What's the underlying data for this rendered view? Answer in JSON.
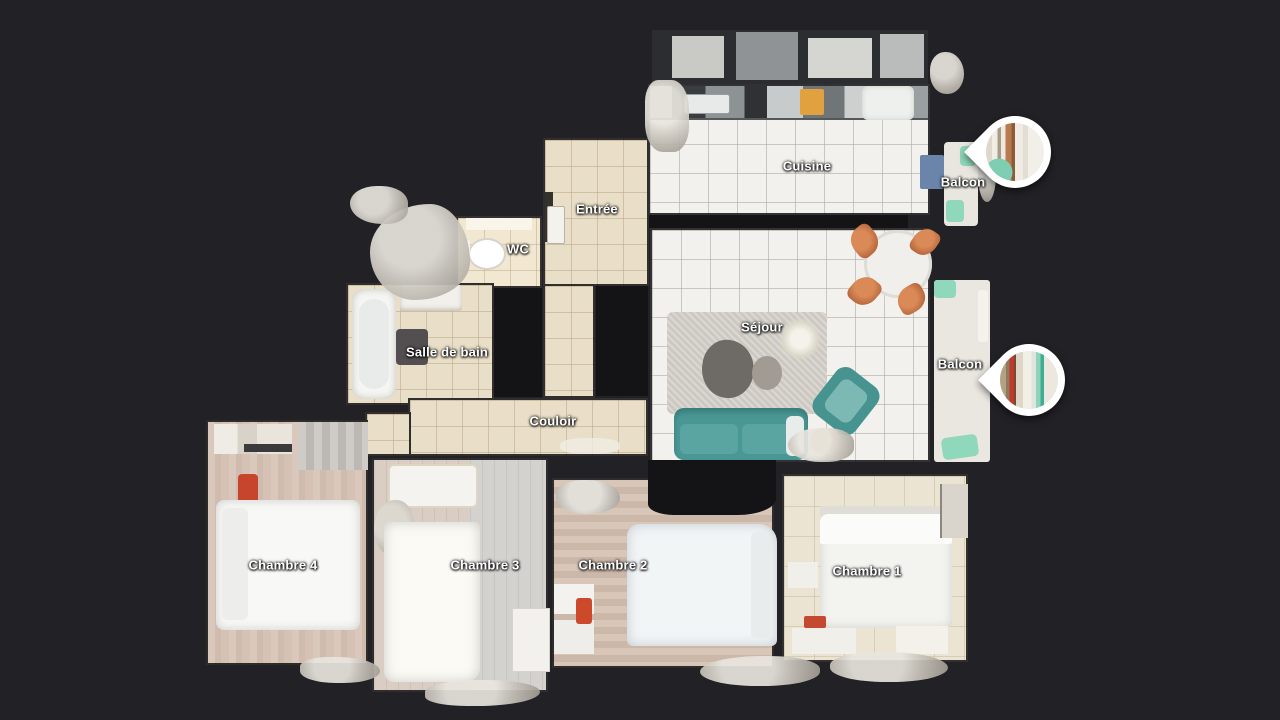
{
  "scene": {
    "type": "3d-dollhouse-floorplan-view",
    "background_color": "#212126",
    "wall_color": "#141417"
  },
  "rooms": [
    {
      "id": "cuisine",
      "label": "Cuisine"
    },
    {
      "id": "balcon-haut",
      "label": "Balcon"
    },
    {
      "id": "entree",
      "label": "Entrée"
    },
    {
      "id": "wc",
      "label": "WC"
    },
    {
      "id": "salle-de-bain",
      "label": "Salle de bain"
    },
    {
      "id": "sejour",
      "label": "Séjour"
    },
    {
      "id": "balcon",
      "label": "Balcon"
    },
    {
      "id": "couloir",
      "label": "Couloir"
    },
    {
      "id": "chambre-4",
      "label": "Chambre 4"
    },
    {
      "id": "chambre-3",
      "label": "Chambre 3"
    },
    {
      "id": "chambre-2",
      "label": "Chambre 2"
    },
    {
      "id": "chambre-1",
      "label": "Chambre 1"
    }
  ],
  "pins": [
    {
      "id": "pin-balcon-haut",
      "icon": "panorama-photo-pin"
    },
    {
      "id": "pin-balcon",
      "icon": "panorama-photo-pin"
    }
  ],
  "palette": {
    "tile_white": "#f2f1ee",
    "tile_beige": "#e9dec8",
    "wood_floor": "#d5c3b6",
    "sofa_teal": "#4a9895",
    "chair_copper": "#b05a33",
    "bed_white": "#f8f8f6",
    "balcony_mint": "#8fd8bb",
    "appliance_blue": "#6b84aa",
    "pin_ring": "#ffffff"
  }
}
